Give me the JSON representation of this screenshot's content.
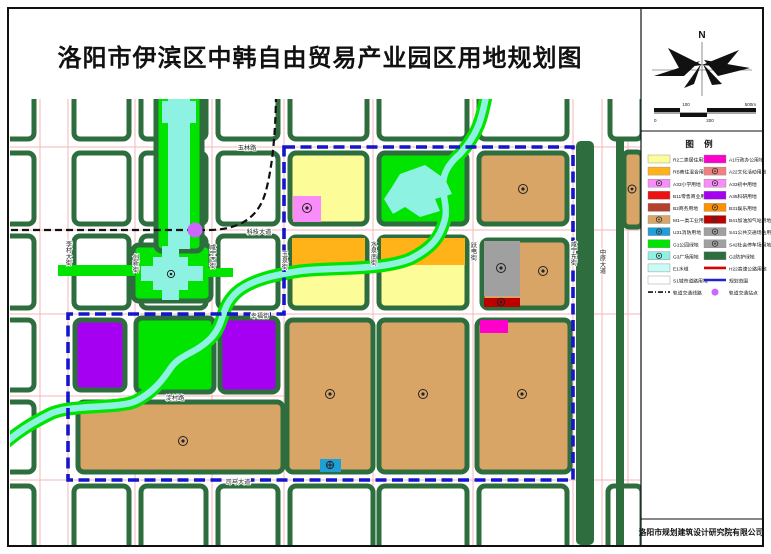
{
  "page": {
    "title": "洛阳市伊滨区中韩自由贸易产业园区用地规划图",
    "publisher": "洛阳市规划建筑设计研究院有限公司"
  },
  "compass": {
    "north_label": "N"
  },
  "scalebar": {
    "labels": [
      "0",
      "100",
      "200",
      "500m"
    ]
  },
  "legend": {
    "title": "图  例",
    "rows": [
      {
        "left": {
          "label": "R2二类居住用地",
          "kind": "fill",
          "color": "#FCFC99"
        },
        "right": {
          "label": "A1行政办公用地",
          "kind": "fill",
          "color": "#FF00CC"
        }
      },
      {
        "left": {
          "label": "RB商住混合用地",
          "kind": "fill",
          "color": "#FFB319"
        },
        "right": {
          "label": "A22文化活动用地",
          "kind": "fill",
          "color": "#F28080",
          "symbol": true
        }
      },
      {
        "left": {
          "label": "A33小学用地",
          "kind": "fill",
          "color": "#FA8CFA",
          "symbol": true
        },
        "right": {
          "label": "A33初中用地",
          "kind": "fill",
          "color": "#FA8CFA",
          "symbol": true
        }
      },
      {
        "left": {
          "label": "B11零售商业用地",
          "kind": "fill",
          "color": "#EE1111"
        },
        "right": {
          "label": "A35科研用地",
          "kind": "fill",
          "color": "#A500F2"
        }
      },
      {
        "left": {
          "label": "B2商务用地",
          "kind": "fill",
          "color": "#B5402C"
        },
        "right": {
          "label": "B31娱乐用地",
          "kind": "fill",
          "color": "#FF9000",
          "symbol": true
        }
      },
      {
        "left": {
          "label": "M1一类工业用地",
          "kind": "fill",
          "color": "#D8A567",
          "symbol": true
        },
        "right": {
          "label": "B41加油加气站用地",
          "kind": "fill",
          "color": "#BB0000",
          "symbol": true
        }
      },
      {
        "left": {
          "label": "U31消防用地",
          "kind": "fill",
          "color": "#1F9FD8",
          "symbol": true
        },
        "right": {
          "label": "S41公共交通场站用地",
          "kind": "fill",
          "color": "#A0A0A0",
          "symbol": true
        }
      },
      {
        "left": {
          "label": "G1公园绿地",
          "kind": "fill",
          "color": "#00E400"
        },
        "right": {
          "label": "S42社会停车场用地",
          "kind": "fill",
          "color": "#A0A0A0",
          "symbol": true
        }
      },
      {
        "left": {
          "label": "G3广场用地",
          "kind": "fill",
          "color": "#8EF2E2",
          "symbol": true
        },
        "right": {
          "label": "G2防护绿地",
          "kind": "fill",
          "color": "#2E6E3E"
        }
      },
      {
        "left": {
          "label": "E1水域",
          "kind": "fill",
          "color": "#C8FBF4"
        },
        "right": {
          "label": "H22高速公路用地",
          "kind": "line",
          "color": "#DD0000"
        }
      },
      {
        "left": {
          "label": "S1城市道路用地",
          "kind": "fill",
          "color": "#FFFFFF"
        },
        "right": {
          "label": "规划范围",
          "kind": "line",
          "color": "#2222CC"
        }
      },
      {
        "left": {
          "label": "轨道交通线路",
          "kind": "dash",
          "color": "#111111"
        },
        "right": {
          "label": "轨道交通站点",
          "kind": "dot",
          "color": "#CC66FF"
        }
      }
    ]
  },
  "palette": {
    "R2": "#FCFC99",
    "RB": "#FFB319",
    "A33": "#FA8CFA",
    "B11": "#EE1111",
    "B2": "#B5402C",
    "M1": "#D8A567",
    "U31": "#1F9FD8",
    "G1": "#00E400",
    "G3": "#8EF2E2",
    "E1": "#8EF2E2",
    "A1": "#FF00CC",
    "A22": "#F28080",
    "A35": "#A500F2",
    "B31": "#FF9000",
    "B41": "#BB0000",
    "S41": "#A0A0A0",
    "S42": "#A0A0A0",
    "G2": "#2E6E3E",
    "road": "#FFFFFF",
    "boundary": "#1515CC",
    "rail": "#111111",
    "station": "#CC66FF",
    "centerline": "#F5B5B5"
  },
  "map": {
    "road_labels": [
      {
        "name": "玉林路",
        "x": 237,
        "y": 51,
        "v": false
      },
      {
        "name": "科技大道",
        "x": 249,
        "y": 135,
        "v": false
      },
      {
        "name": "幸福街",
        "x": 250,
        "y": 219,
        "v": false
      },
      {
        "name": "淀村路",
        "x": 165,
        "y": 301,
        "v": false
      },
      {
        "name": "司马大道",
        "x": 228,
        "y": 385,
        "v": false
      },
      {
        "name": "李村大街",
        "x": 58,
        "y": 142,
        "v": true
      },
      {
        "name": "创新街",
        "x": 125,
        "y": 155,
        "v": true
      },
      {
        "name": "咸宁西街",
        "x": 202,
        "y": 145,
        "v": true
      },
      {
        "name": "玉泉街",
        "x": 274,
        "y": 152,
        "v": true
      },
      {
        "name": "水泉南街",
        "x": 363,
        "y": 142,
        "v": true
      },
      {
        "name": "跃电街",
        "x": 463,
        "y": 143,
        "v": true
      },
      {
        "name": "咸宁东街",
        "x": 563,
        "y": 142,
        "v": true
      },
      {
        "name": "中原大道",
        "x": 592,
        "y": 150,
        "v": true
      }
    ]
  }
}
